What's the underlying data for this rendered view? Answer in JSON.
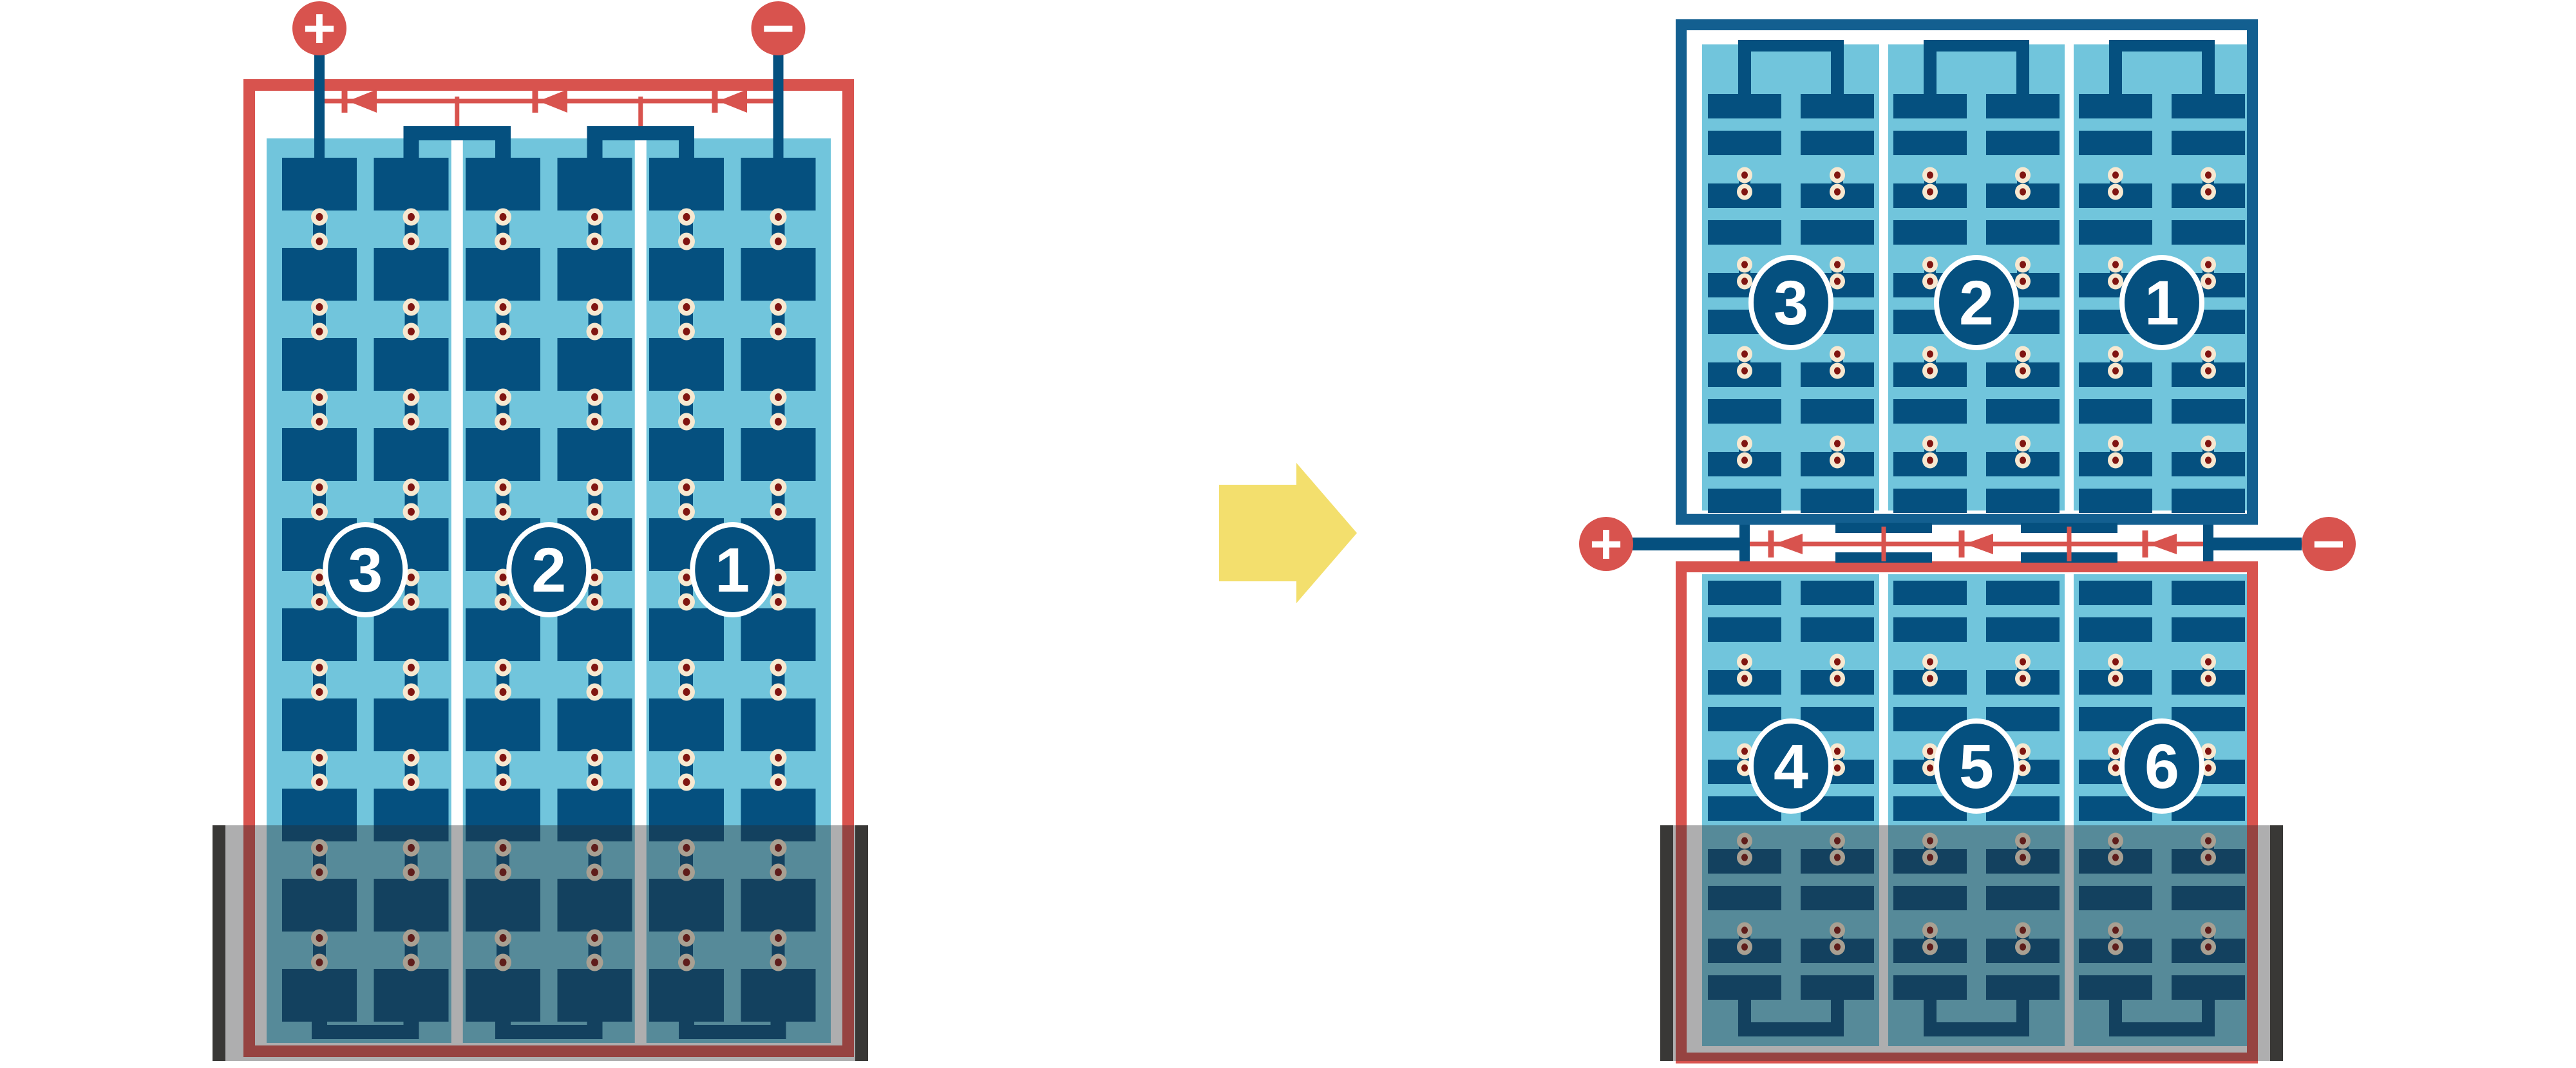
{
  "diagram_type": "solar-module-wiring-comparison",
  "colors": {
    "red": "#D8534E",
    "frame_blue": "#135F90",
    "cell_blue": "#05507F",
    "light_blue": "#71C5DC",
    "cream": "#F7E8D0",
    "dot_red": "#801511",
    "shade": "#2B2B2D",
    "shade_opacity": "0.38",
    "shade_cap": "#393836",
    "arrow_yellow": "#F3DF6D",
    "white": "#FFFFFF"
  },
  "left_module": {
    "positive_terminal": "+",
    "negative_terminal": "−",
    "strings": [
      {
        "label": "3"
      },
      {
        "label": "2"
      },
      {
        "label": "1"
      }
    ],
    "rows_per_string": 10,
    "cell_style": "full",
    "bypass_diodes": 3,
    "shaded_bottom": true
  },
  "transition": {
    "arrow_direction": "right"
  },
  "right_module": {
    "positive_terminal": "+",
    "negative_terminal": "−",
    "top_panel": {
      "strings": [
        {
          "label": "3"
        },
        {
          "label": "2"
        },
        {
          "label": "1"
        }
      ],
      "rows_per_string": 10,
      "cell_style": "half"
    },
    "bottom_panel": {
      "strings": [
        {
          "label": "4"
        },
        {
          "label": "5"
        },
        {
          "label": "6"
        }
      ],
      "rows_per_string": 10,
      "cell_style": "half"
    },
    "bypass_diodes": 3,
    "shaded_bottom": true
  }
}
